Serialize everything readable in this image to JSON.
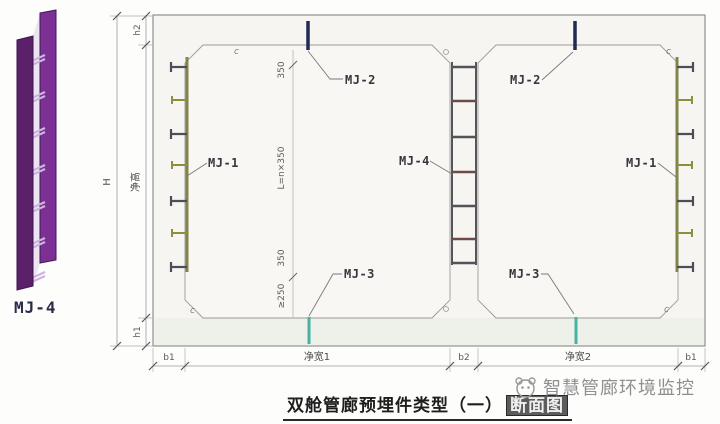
{
  "legend": {
    "label": "MJ-4"
  },
  "labels": {
    "mj1": "MJ-1",
    "mj2": "MJ-2",
    "mj3": "MJ-3",
    "mj4": "MJ-4"
  },
  "dimensions": {
    "overall_height": "H",
    "roof_thickness": "h2",
    "net_height": "净高",
    "floor_thickness": "h1",
    "wall_left": "b1",
    "net_width_left": "净宽1",
    "wall_middle": "b2",
    "net_width_right": "净宽2",
    "wall_right": "b1",
    "rung_top_offset": "350",
    "rung_spacing": "L=n×350",
    "rung_bottom_offset": "350",
    "rung_min_clearance": "≥250",
    "chamfer": "c"
  },
  "title": {
    "text_main": "双舱管廊预埋件类型（一）",
    "text_boxed": "断面图"
  },
  "watermark": {
    "text": "智慧管廊环境监控"
  },
  "colors": {
    "legend_rail_front": "#5a2069",
    "legend_rail_back": "#7c3094",
    "legend_rail_gap": "#ddd0e8",
    "legend_rung": "#cdb4de",
    "mj1_plate": "#83834a",
    "mj1_stud_dark": "#4e4e58",
    "mj1_stud_olive": "#8e8e3c",
    "mj2_bar": "#1f2a55",
    "mj3_bar": "#47b2a2",
    "mj4_rail": "#55555c",
    "mj4_rung_dark": "#53535a",
    "mj4_rung_red": "#6e4a4a",
    "line_gray": "#909090",
    "watermark_gray": "#8f8f8f"
  }
}
